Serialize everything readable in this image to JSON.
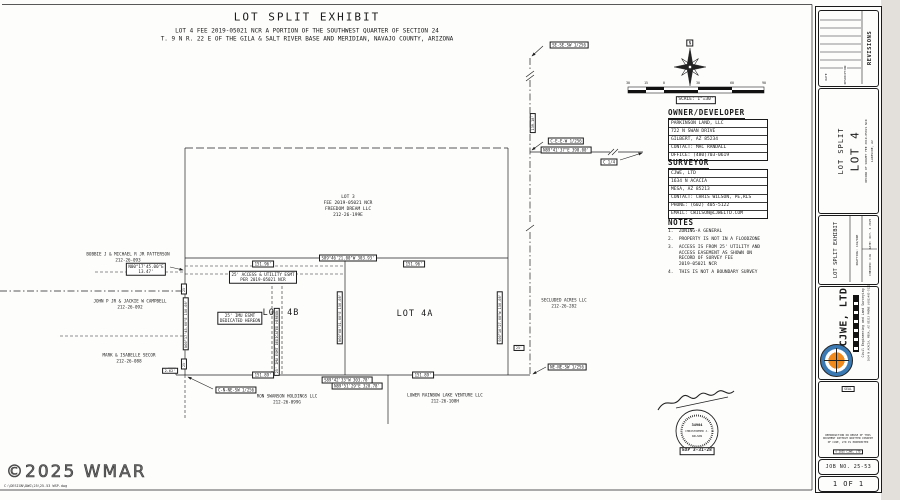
{
  "header": {
    "title": "LOT SPLIT EXHIBIT",
    "sub1": "LOT 4 FEE 2019-05021 NCR  A PORTION OF THE SOUTHWEST QUARTER OF  SECTION 24",
    "sub2": "T. 9 N R. 22 E OF THE GILA & SALT RIVER BASE AND MERIDIAN, NAVAJO COUNTY, ARIZONA"
  },
  "compass": {
    "north": "N"
  },
  "scale": {
    "label": "SCALE: 1\"=30'",
    "ticks": [
      "30",
      "15",
      "0",
      "30",
      "60",
      "90"
    ]
  },
  "owner": {
    "heading": "OWNER/DEVELOPER",
    "lines": [
      "PARKINSON LAND, LLC",
      "722 N SWAN DRIVE",
      "GILBERT, AZ 85234",
      "CONTACT: MAC RANDALL",
      "OFFICE: (480)703-0619"
    ]
  },
  "surveyor": {
    "heading": "SURVEYOR",
    "lines": [
      "CJWE, LTD",
      "1634 N ACACIA",
      "MESA, AZ 85213",
      "CONTACT: CHRIS WILSON, PE,RLS",
      "PHONE: (602) 405-5122",
      "EMAIL: CWILSON@CJWELTD.COM"
    ]
  },
  "notes": {
    "heading": "NOTES",
    "items": [
      "1.  ZONING-A GENERAL",
      "2.  PROPERTY IS NOT IN A FLOODZONE",
      "3.  ACCESS IS FROM 25' UTILITY AND\n    ACCESS EASEMENT AS SHOWN ON\n    RECORD OF SURVEY FEE\n    2019-05021 NCR",
      "4.  THIS IS NOT A BOUNDARY SURVEY"
    ]
  },
  "plan": {
    "lot3": {
      "l1": "LOT 3",
      "l2": "FEE 2019-05021 NCR",
      "l3": "FREEDOM DREAM LLC",
      "l4": "212-26-199E"
    },
    "lot4b": "LOT 4B",
    "lot4a": "LOT 4A",
    "owners": {
      "patterson": {
        "l1": "BOBBIE J & MICHAEL R JR PATTERSON",
        "l2": "212-26-093"
      },
      "campbell": {
        "l1": "JOHN P JR & JACKIE W CAMPBELL",
        "l2": "212-26-092"
      },
      "secor": {
        "l1": "MARK & ISABELLE SECOR",
        "l2": "212-26-088"
      },
      "secluded": {
        "l1": "SECLUDED ACRES LLC",
        "l2": "212-26-282"
      },
      "swanson": {
        "l1": "RON SWANSON HOLDINGS LLC",
        "l2": "212-26-099G"
      },
      "rainbow": {
        "l1": "LOWER RAINBOW LAKE VENTURE LLC",
        "l2": "212-26-108H"
      }
    },
    "easements": {
      "access1": "25' ACCESS & UTILITY ESMT",
      "access2": "PER 2019-05021 NCR",
      "imu1": "25' IMU ESMT",
      "imu2": "DEDICATED HEREON",
      "imu_v": "25' IMU ESMT DEDICATED HEREON"
    },
    "dims": {
      "top_left": "151.96'",
      "top_mid": "S89°46'21.00\"W  303.93'",
      "top_right": "151.96'",
      "bot_left": "151.89'",
      "bot_brg1": "S89°42'33\"W  303.78'",
      "bot_brg2": "N89°51'29\"E  328.78'",
      "bot_right": "151.89'",
      "jog": "2.62'",
      "west_brg": "N00°17'45.00\"E",
      "west_len": "13.47'",
      "west_side": "N00°17'45.00\"E  150.08'",
      "mid_side": "N00°08'31.00\"E  150.08'",
      "east_side": "S00°10'27.00\"W  150.08'",
      "north_len": "139.18'",
      "east_line": "N89°41'37\"E  398.00'",
      "off_e": "25'",
      "off_w1": "25'",
      "off_w2": "25'"
    },
    "corners": {
      "sese": "SE-SE-SW 1/256",
      "ceew": "C-E-E-W 1/256",
      "c14": "C 1/4",
      "nene": "NE-NE-SW 1/256",
      "cnne": "C-N-NE-SW 1/256"
    }
  },
  "stamp": {
    "no": "34904",
    "name1": "CHRISTOPHER J.",
    "name2": "WILSON",
    "exp": "EXP 3-31-28"
  },
  "titleblock": {
    "revisions": {
      "title": "REVISIONS",
      "date": "DATE",
      "desc": "DESCRIPTION"
    },
    "project": {
      "l1": "LOT SPLIT",
      "l2": "LOT 4",
      "s1": "RECORD OF SURVEY FEE 2019-05021 NCR",
      "s2": "LAKESIDE, AZ"
    },
    "exhibit": {
      "title": "LOT SPLIT EXHIBIT",
      "drafting": "DRAFTING: CJW/DRE",
      "checked": "CHECKED: CJW",
      "date": "DATE: OCT. 3 2025"
    },
    "firm": {
      "name": "CJWE, LTD",
      "tag": "Civil Engineering and Land Surveying",
      "addr": "1634 N ACACIA, MESA, AZ 85213  PHONE (602)405-5122"
    },
    "seal_label": "SEAL",
    "disclaimer": "REPRODUCTION OR REUSE OF THIS DOCUMENT WITHOUT WRITTEN CONSENT OF CJWE, LTD IS PROHIBITED",
    "copyright": "© 2025 CJWE, LTD",
    "job": "JOB NO. 25-53",
    "sheet": "1 OF 1"
  },
  "footer": {
    "copyright": "©2025 WMAR",
    "filepath": "C:\\DESIGN\\DWG\\25\\25-53 WSP.dwg"
  }
}
